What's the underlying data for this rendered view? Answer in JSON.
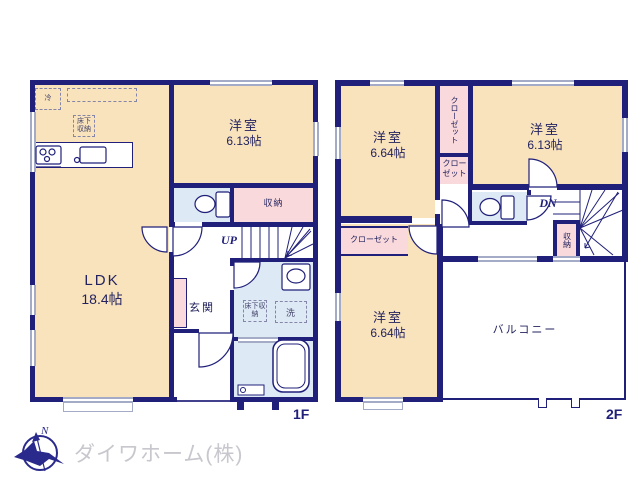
{
  "palette": {
    "wall_navy": "#20207a",
    "room_beige": "#f8e3bd",
    "closet_pink": "#f9d9db",
    "wet_area_blue": "#dde9f5",
    "window_gray": "#a4abc7",
    "label_navy": "#23235f",
    "logo_gray": "#c7c7cd"
  },
  "floor1": {
    "label": "1F",
    "ldk": {
      "name": "LDK",
      "size": "18.4帖"
    },
    "western": {
      "name": "洋室",
      "size": "6.13帖"
    },
    "storage": "収納",
    "up": "UP",
    "entrance": "玄関",
    "underfloor": "床下収納",
    "fridge": "冷",
    "laundry": "洗"
  },
  "floor2": {
    "label": "2F",
    "western_a": {
      "name": "洋室",
      "size": "6.64帖"
    },
    "western_b": {
      "name": "洋室",
      "size": "6.13帖"
    },
    "western_c": {
      "name": "洋室",
      "size": "6.64帖"
    },
    "closet_tall": "クローゼット",
    "closet_small": "クローゼット",
    "closet_wide": "クローゼット",
    "storage": "収納",
    "dn": "DN",
    "balcony": "バルコニー"
  },
  "logo": {
    "north": "N",
    "company": "ダイワホーム(株)"
  }
}
